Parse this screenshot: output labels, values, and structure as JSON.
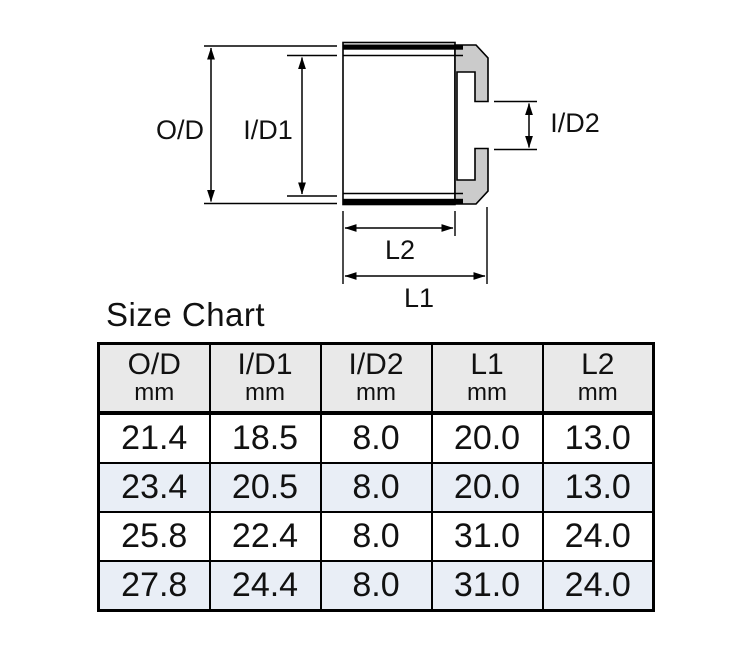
{
  "diagram": {
    "name": "fitting cross-section with dimension callouts",
    "labels": {
      "od": "O/D",
      "id1": "I/D1",
      "id2": "I/D2",
      "l1": "L1",
      "l2": "L2"
    },
    "colors": {
      "cap_fill": "#cbcbcb",
      "line": "#000000"
    }
  },
  "size_chart": {
    "title": "Size Chart",
    "columns": [
      {
        "label": "O/D",
        "unit": "mm"
      },
      {
        "label": "I/D1",
        "unit": "mm"
      },
      {
        "label": "I/D2",
        "unit": "mm"
      },
      {
        "label": "L1",
        "unit": "mm"
      },
      {
        "label": "L2",
        "unit": "mm"
      }
    ],
    "rows": [
      [
        "21.4",
        "18.5",
        "8.0",
        "20.0",
        "13.0"
      ],
      [
        "23.4",
        "20.5",
        "8.0",
        "20.0",
        "13.0"
      ],
      [
        "25.8",
        "22.4",
        "8.0",
        "31.0",
        "24.0"
      ],
      [
        "27.8",
        "24.4",
        "8.0",
        "31.0",
        "24.0"
      ]
    ],
    "colors": {
      "header_bg": "#e9e9e9",
      "row_alt_bg": "#e9eef6",
      "border": "#000000"
    }
  },
  "chart_data": {
    "type": "table",
    "title": "Size Chart",
    "columns": [
      "O/D mm",
      "I/D1 mm",
      "I/D2 mm",
      "L1 mm",
      "L2 mm"
    ],
    "rows": [
      [
        21.4,
        18.5,
        8.0,
        20.0,
        13.0
      ],
      [
        23.4,
        20.5,
        8.0,
        20.0,
        13.0
      ],
      [
        25.8,
        22.4,
        8.0,
        31.0,
        24.0
      ],
      [
        27.8,
        24.4,
        8.0,
        31.0,
        24.0
      ]
    ]
  }
}
